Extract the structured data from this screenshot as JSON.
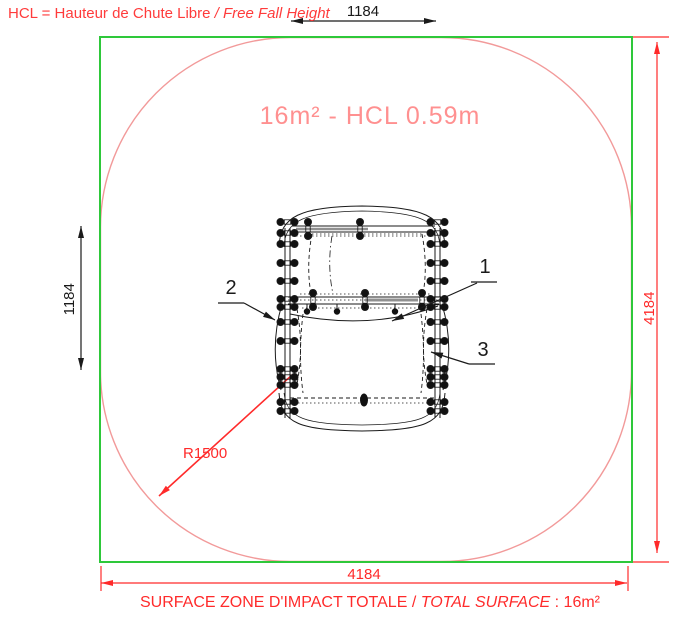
{
  "note": {
    "main": "HCL = Hauteur de Chute Libre ",
    "italic": "/ Free Fall Height"
  },
  "zone_label": "16m² - HCL 0.59m",
  "dimensions": {
    "equipment_width": "1184",
    "equipment_depth": "1184",
    "zone_height": "4184",
    "zone_width": "4184",
    "corner_radius": "R1500"
  },
  "part_labels": [
    "1",
    "2",
    "3"
  ],
  "footer": {
    "main": "SURFACE ZONE D'IMPACT TOTALE / ",
    "italic": "TOTAL SURFACE",
    "suffix": " : 16m²"
  },
  "colors": {
    "zone_border_green": "#2ec83a",
    "impact_zone_pink": "#f29a9a",
    "dimension_red": "#ff2a2a",
    "zone_label_pink": "#ff9090",
    "note_red": "#ff3b3b",
    "drawing_black": "#1a1a1a"
  }
}
